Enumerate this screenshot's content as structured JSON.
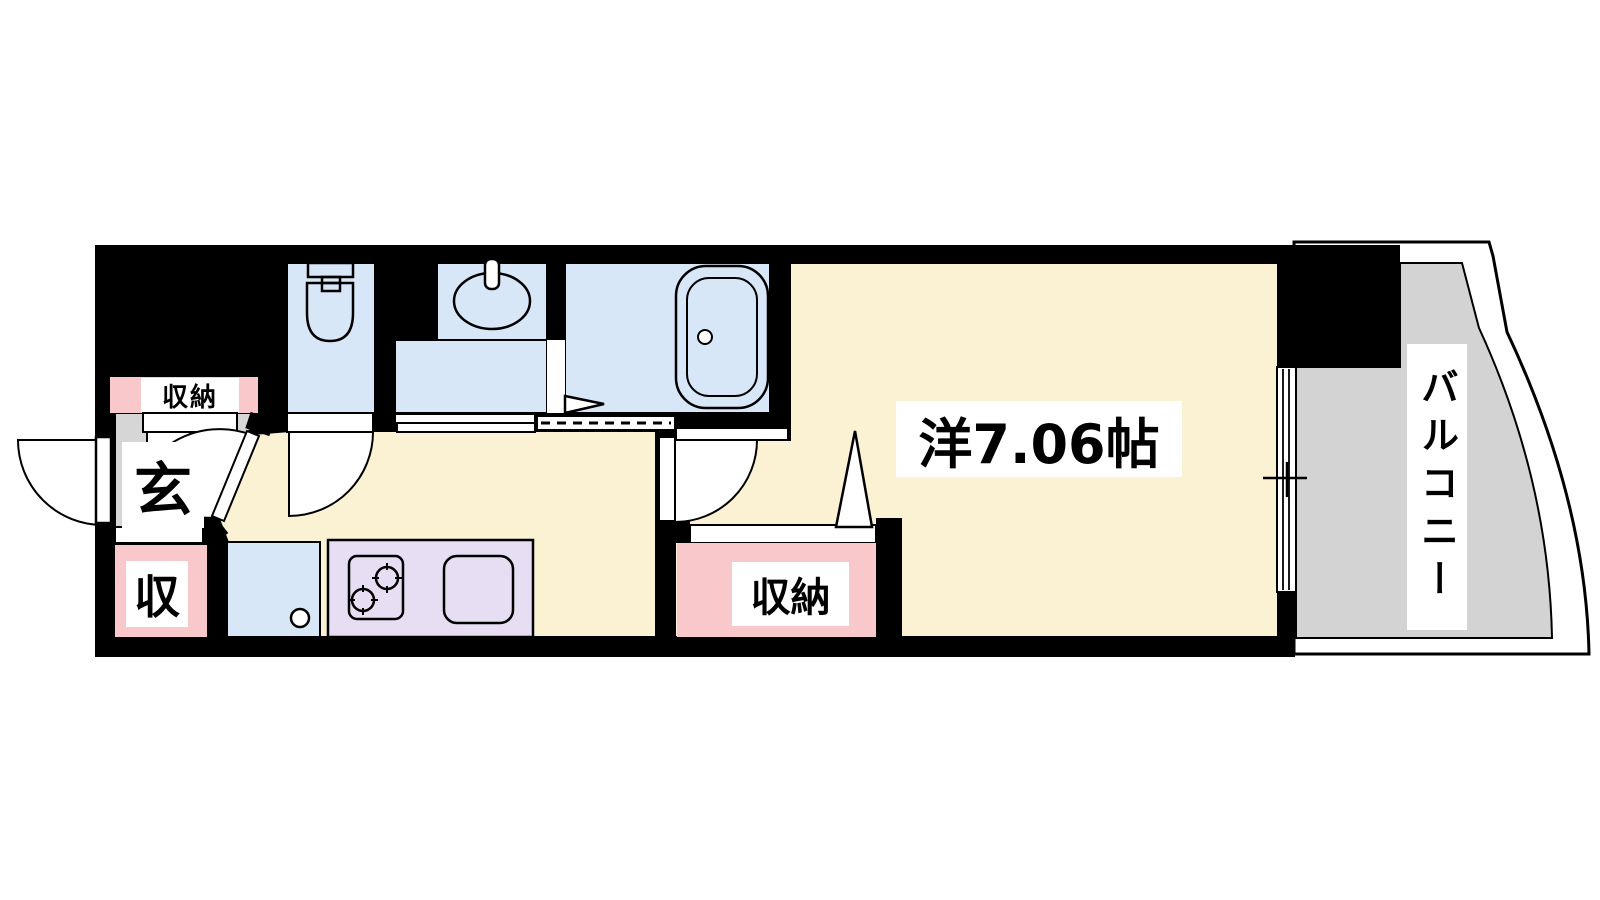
{
  "floor_plan": {
    "labels": {
      "main_room": "洋7.06帖",
      "balcony": "バルコニー",
      "storage_upper": "収納",
      "storage_closet": "収納",
      "storage_small": "収",
      "entrance": "玄"
    },
    "colors": {
      "wall": "#000000",
      "room_floor": "#FBF1D3",
      "wet_area": "#D8E7F7",
      "storage_pink": "#F9C8CB",
      "kitchen_counter": "#E7DEF3",
      "balcony_gray": "#D3D3D3",
      "genkan_gray": "#D6D6D6",
      "door_white": "#FFFFFF"
    }
  }
}
